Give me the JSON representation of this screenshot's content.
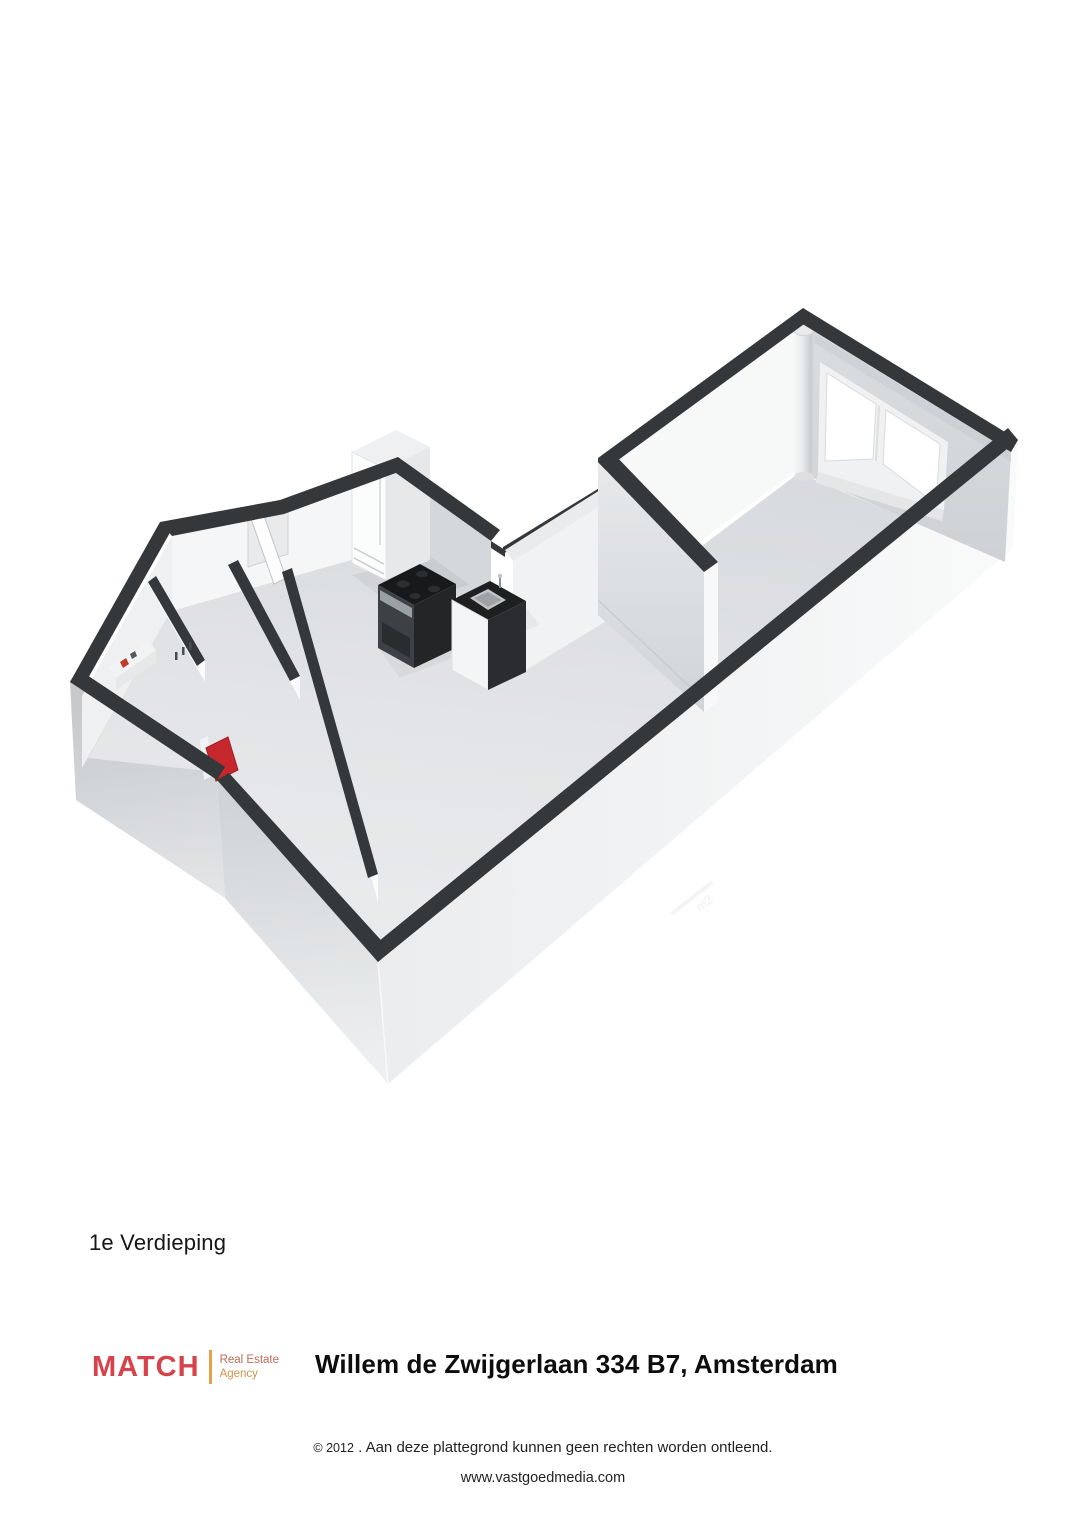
{
  "theme": {
    "wall-top": "#34383b",
    "floor-a": "#d7dade",
    "floor-b": "#e9ebee",
    "red": "#c5272d",
    "brand": "#d6434b",
    "logo-bar": "#e5a04a",
    "tag1": "#bf6b5a",
    "tag2": "#d4924a",
    "ink": "#1b1b1b",
    "page": "#ffffff"
  },
  "floorplan": {
    "label": "1e Verdieping",
    "watermark": "m2",
    "view": "3d-isometric",
    "rooms": [
      "hoofdkamer",
      "keuken",
      "hal",
      "badkamer",
      "toilet"
    ],
    "features": [
      "double-window",
      "pass-through-sill",
      "pipe-column",
      "fridge",
      "stove",
      "sink-unit",
      "red-shower-tray",
      "entrance-door"
    ]
  },
  "footer": {
    "logo": {
      "brand": "MATCH",
      "tagline_line1": "Real Estate",
      "tagline_line2": "Agency"
    },
    "title": "Willem de Zwijgerlaan 334 B7, Amsterdam",
    "copyright_symbol_year": "© 2012",
    "copyright_text": ". Aan deze plattegrond kunnen geen rechten worden ontleend.",
    "website": "www.vastgoedmedia.com"
  }
}
